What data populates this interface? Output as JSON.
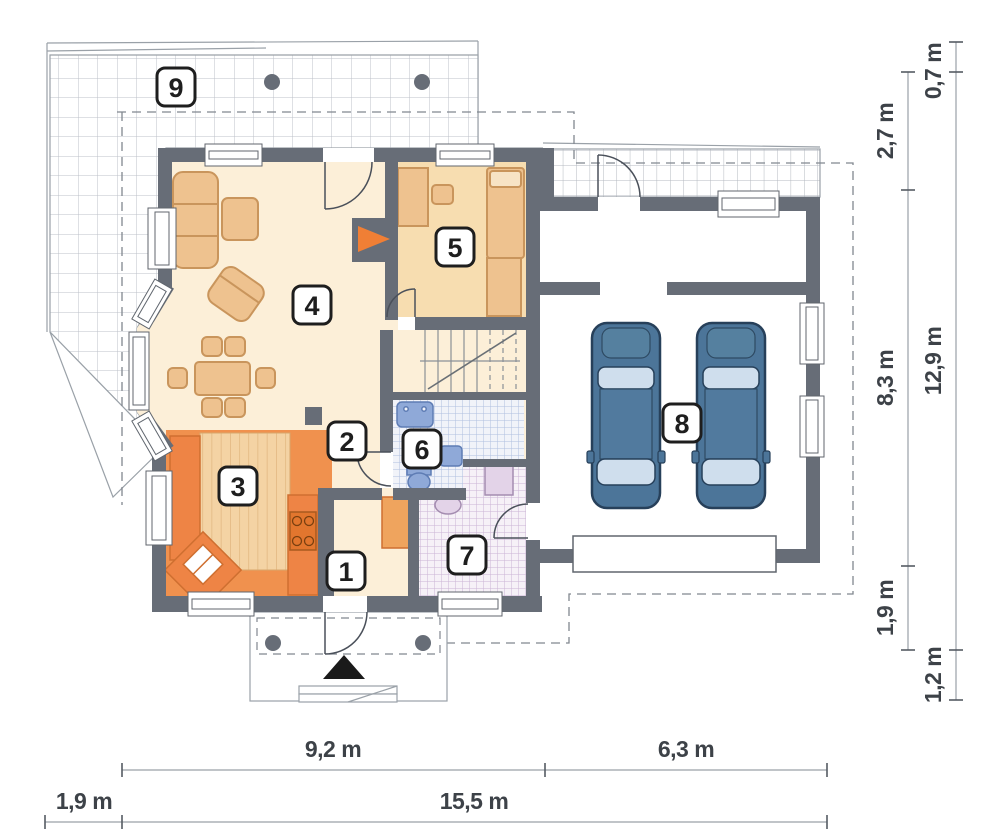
{
  "plan": {
    "type": "floor-plan",
    "unit": "m"
  },
  "rooms": [
    {
      "label": "1"
    },
    {
      "label": "2"
    },
    {
      "label": "3"
    },
    {
      "label": "4"
    },
    {
      "label": "5"
    },
    {
      "label": "6"
    },
    {
      "label": "7"
    },
    {
      "label": "8"
    },
    {
      "label": "9"
    }
  ],
  "dimensions": {
    "right_inner": [
      {
        "label": "2,7 m"
      },
      {
        "label": "8,3 m"
      },
      {
        "label": "1,9 m"
      }
    ],
    "right_outer": [
      {
        "label": "0,7 m"
      },
      {
        "label": "12,9 m"
      },
      {
        "label": "1,2 m"
      }
    ],
    "bottom_upper": [
      {
        "label": "9,2 m"
      },
      {
        "label": "6,3 m"
      }
    ],
    "bottom_lower": [
      {
        "label": "1,9 m"
      },
      {
        "label": "15,5 m"
      }
    ]
  },
  "colors": {
    "wall": "#676d77",
    "outline": "#9aa1a8",
    "floor_cream": "#fcefd8",
    "floor_room5": "#f7ddb0",
    "kitchen_orange": "#f0914e",
    "counter_orange": "#ee8445",
    "accent_orange": "#f07f35",
    "furniture_tan": "#eec28f",
    "car_blue": "#4c7599",
    "tile_blue_line": "#b0bfe0",
    "tile_pink_line": "#cbb4d4"
  }
}
